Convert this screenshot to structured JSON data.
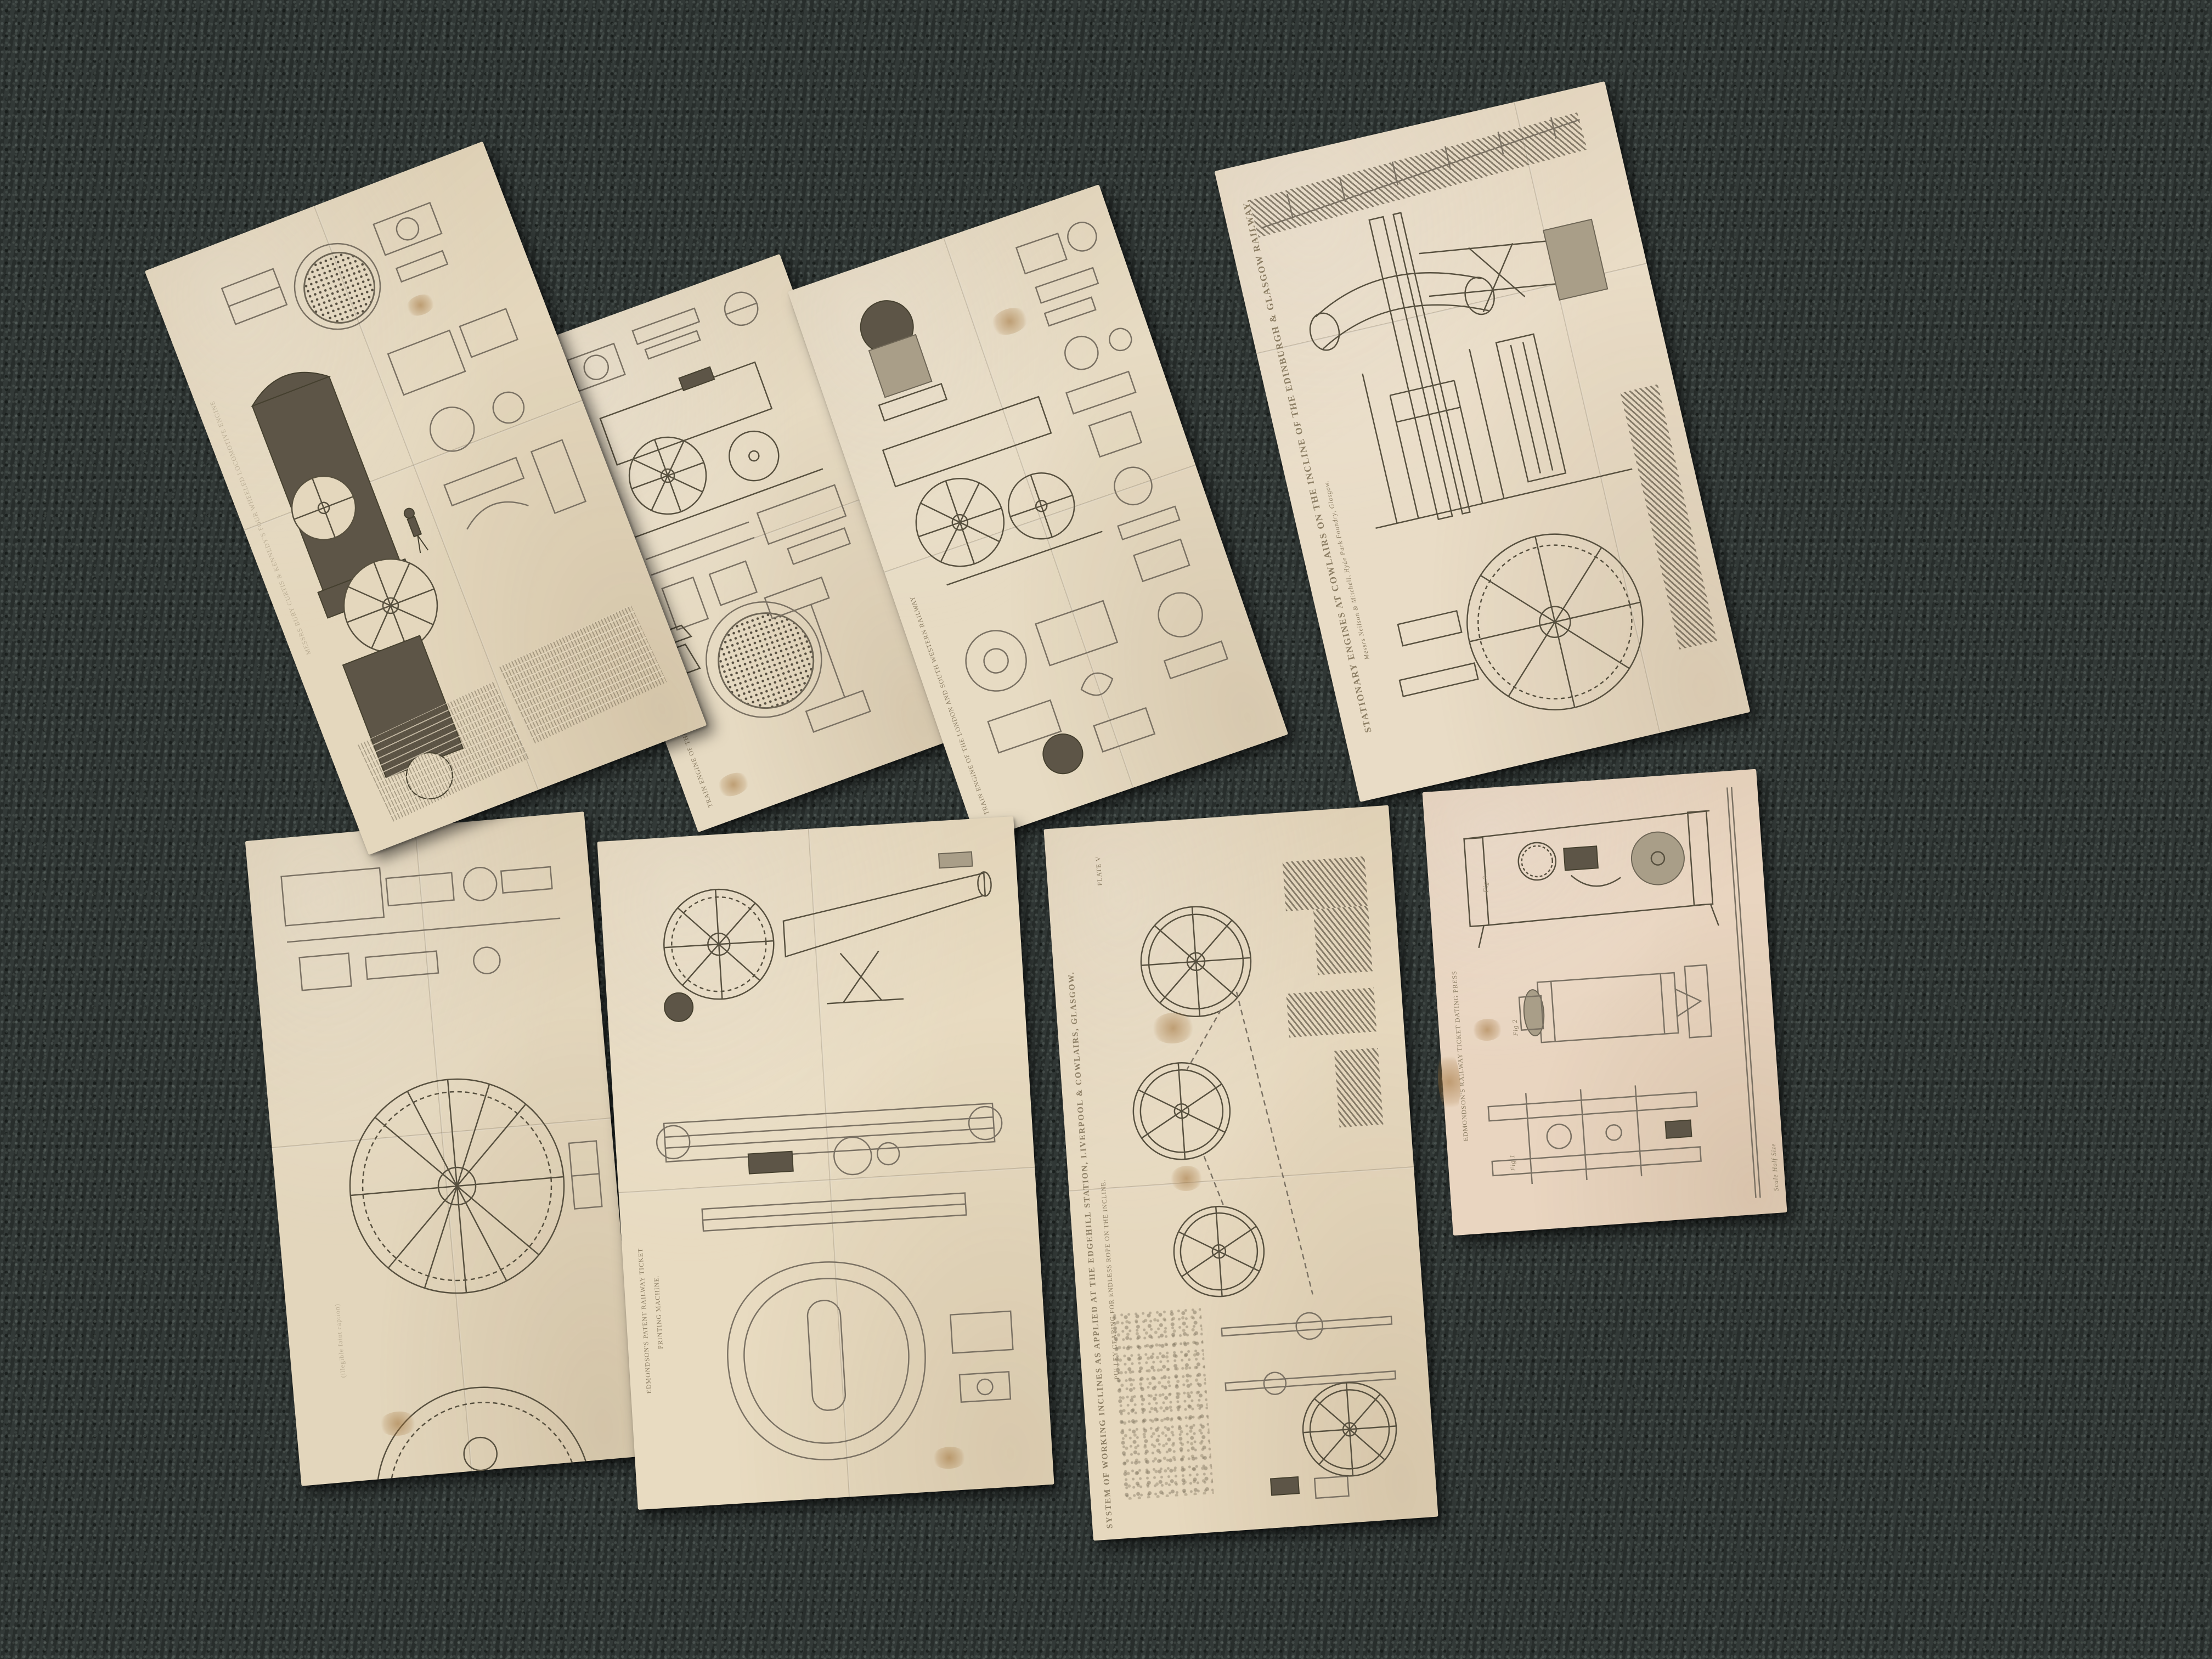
{
  "scene": {
    "description": "Photograph of eight antique folded engineering plates (1840s railway machinery engravings) laid out in two rows on a dark green-grey tweed carpet",
    "colors": {
      "carpet": "#2e3533",
      "carpet_speckle_light": "#8a948e",
      "paper": "#e6dac2",
      "paper_pink": "#e9d6c0",
      "ink": "#7a7163",
      "dark_engraving": "#5d5547",
      "caption": "#8c7e64",
      "foxing": "#9e6e34"
    }
  },
  "sheets": [
    {
      "id": "sheet-1",
      "subject": "Dark engraved side elevation of an early locomotive with tender, boiler tube-plate, detail figures and two columns of reference text (plate rotated sideways)",
      "caption": "MESSRS BURY CURTIS & KENNEDY'S FOUR WHEELED LOCOMOTIVE ENGINE"
    },
    {
      "id": "sheet-2",
      "subject": "Locomotive elevation with large wheel, boiler front with tube holes and chimney details (plate rotated sideways)",
      "caption": "TRAIN ENGINE OF THE LONDON AND SOUTH WESTERN RAILWAY"
    },
    {
      "id": "sheet-3",
      "subject": "Locomotive side elevation with driving wheels, domed boiler and columns of constructional detail figures (plate rotated sideways)",
      "caption": "TRAIN ENGINE OF THE LONDON AND SOUTH WESTERN RAILWAY"
    },
    {
      "id": "sheet-4",
      "subject": "Beam framing, columns and large toothed flywheel of winding engines, with hatched masonry (plate rotated sideways)",
      "caption": "STATIONARY ENGINES AT COWLAIRS ON THE INCLINE OF THE EDINBURGH & GLASGOW RAILWAY,",
      "maker": "Messrs Neilson & Mitchell, Hyde Park Foundry, Glasgow."
    },
    {
      "id": "sheet-5",
      "subject": "Large spoked spur-wheel / winding drum in plan with small horizontal engine above (plate rotated sideways)",
      "caption": "(illegible faint caption)"
    },
    {
      "id": "sheet-6",
      "subject": "Ticket printing machine: toothed gear, inking cylinder, long press bed and shaped frame plate",
      "caption_line1": "EDMONDSON'S PATENT RAILWAY TICKET",
      "caption_line2": "PRINTING MACHINE."
    },
    {
      "id": "sheet-7",
      "subject": "Plan of pulley wheels and endless rope gearing on an incline with hatched masonry pits",
      "plate_no": "PLATE V",
      "caption": "SYSTEM OF WORKING INCLINES AS APPLIED AT THE EDGEHILL STATION, LIVERPOOL & COWLAIRS, GLASGOW.",
      "subtitle": "PULLEY GEARING FOR ENDLESS ROPE ON THE INCLINE."
    },
    {
      "id": "sheet-8",
      "subject": "Three figures of a ticket dating press: side elevation, front elevation and plan",
      "caption": "EDMONDSON'S RAILWAY TICKET DATING PRESS",
      "figures": [
        "Fig 1",
        "Fig 2",
        "Fig 3"
      ],
      "scale_note": "Scale Half Size"
    }
  ]
}
